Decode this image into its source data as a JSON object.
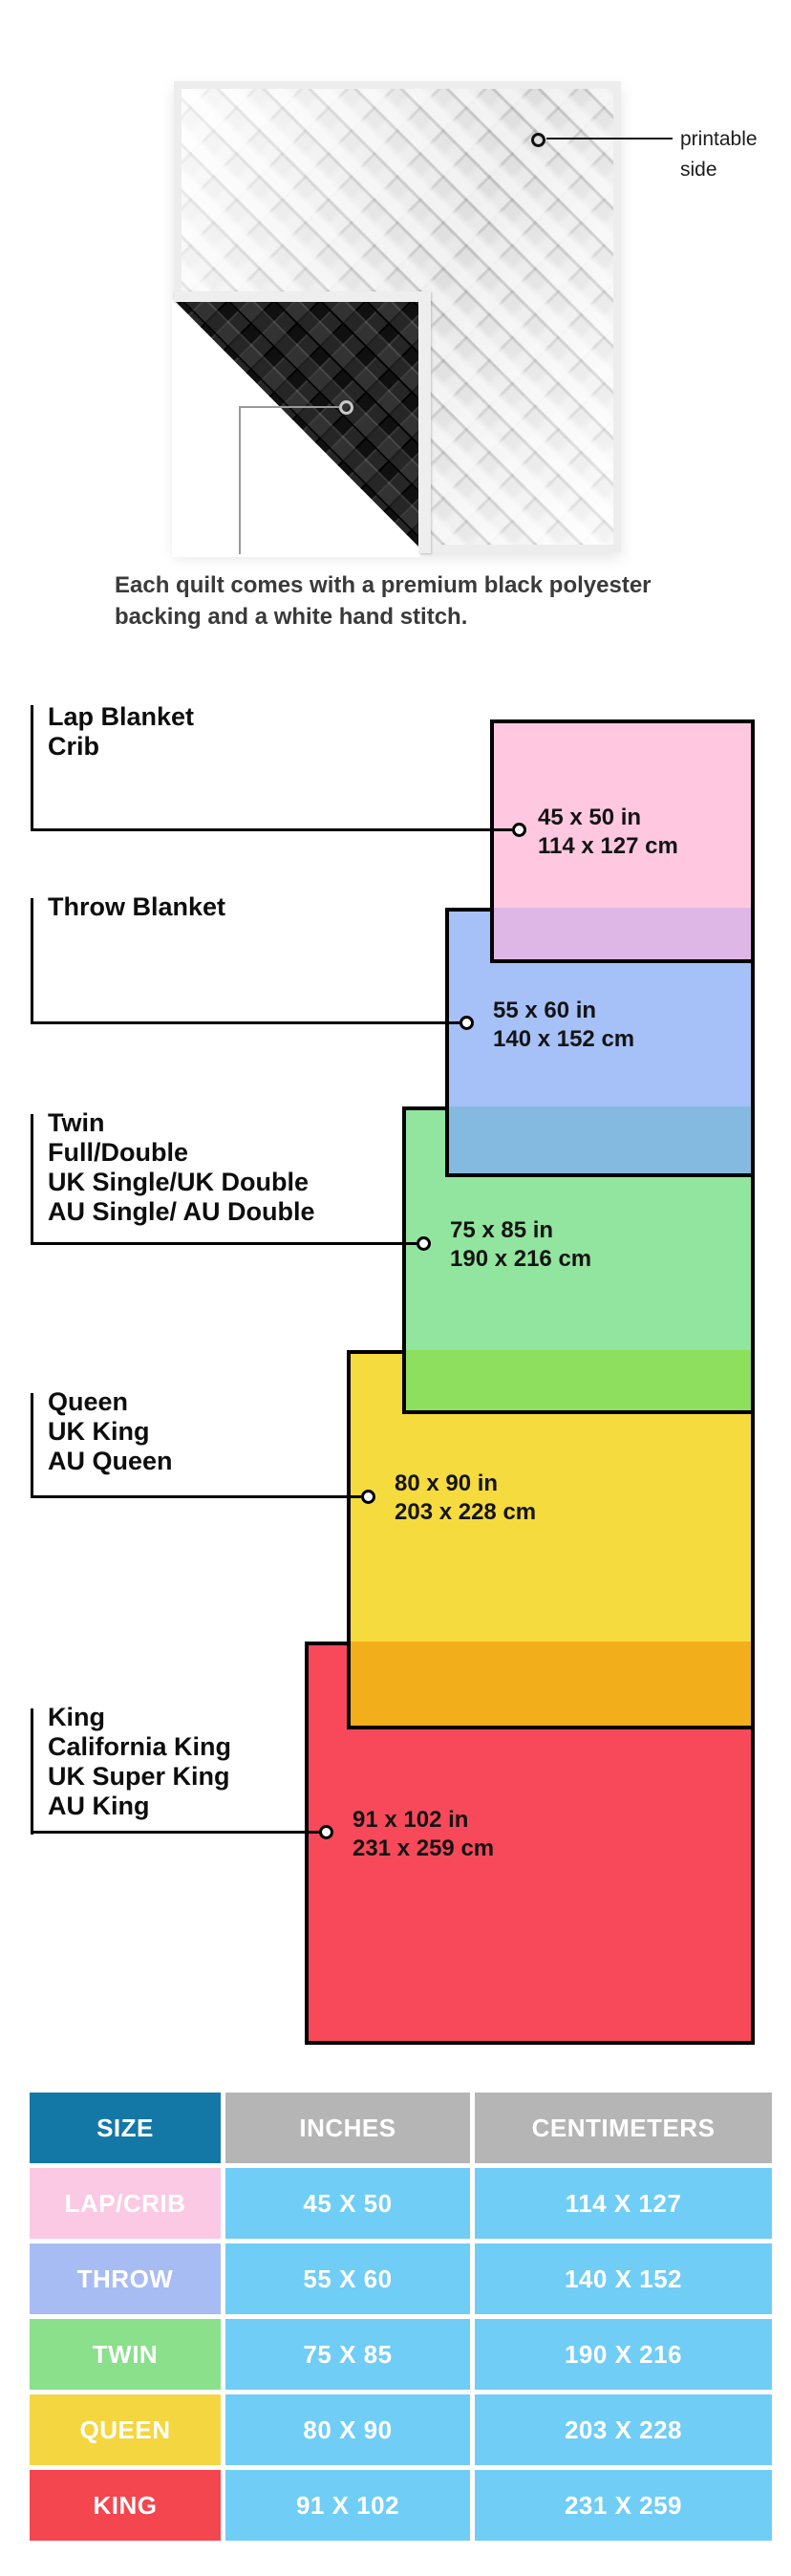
{
  "quilt_section": {
    "printable_lines": [
      "printable",
      "side"
    ],
    "caption_lines": [
      "Each quilt comes with a premium black polyester",
      "backing and a white hand stitch."
    ],
    "front_color": "#f3f3f3",
    "backing_color": "#101010"
  },
  "diagram": {
    "blankets": [
      {
        "id": "lap",
        "label_lines": [
          "Lap Blanket",
          "Crib"
        ],
        "size_in": "45 x 50 in",
        "size_cm": "114 x 127 cm",
        "fill": "#FFC8E0",
        "overlap_band": "#DEB7E6"
      },
      {
        "id": "throw",
        "label_lines": [
          "Throw Blanket"
        ],
        "size_in": "55 x 60 in",
        "size_cm": "140 x 152 cm",
        "fill": "#A6C0F8",
        "overlap_band": "#85BAE0"
      },
      {
        "id": "twin",
        "label_lines": [
          "Twin",
          "Full/Double",
          "UK Single/UK Double",
          "AU Single/ AU Double"
        ],
        "size_in": "75 x 85 in",
        "size_cm": "190 x 216 cm",
        "fill": "#92E59E",
        "overlap_band": "#8EDF5D"
      },
      {
        "id": "queen",
        "label_lines": [
          "Queen",
          "UK King",
          "AU Queen"
        ],
        "size_in": "80 x 90 in",
        "size_cm": "203 x 228 cm",
        "fill": "#F5DB3E",
        "overlap_band": "#F3AE1B"
      },
      {
        "id": "king",
        "label_lines": [
          "King",
          "California King",
          "UK Super King",
          "AU King"
        ],
        "size_in": "91 x 102 in",
        "size_cm": "231 x 259 cm",
        "fill": "#F8495B",
        "overlap_band": null
      }
    ],
    "border_color": "#000000"
  },
  "table": {
    "headers": [
      "SIZE",
      "INCHES",
      "CENTIMETERS"
    ],
    "header_size_bg": "#1478A6",
    "header_other_bg": "#B5B5B5",
    "value_cell_bg": "#70CDF6",
    "rows": [
      {
        "size": "LAP/CRIB",
        "inches": "45 X 50",
        "centimeters": "114 X 127",
        "size_bg": "#FBC9E3"
      },
      {
        "size": "THROW",
        "inches": "55 X 60",
        "centimeters": "140 X 152",
        "size_bg": "#A8BCF4"
      },
      {
        "size": "TWIN",
        "inches": "75 X 85",
        "centimeters": "190 X 216",
        "size_bg": "#8BE08B"
      },
      {
        "size": "QUEEN",
        "inches": "80 X 90",
        "centimeters": "203 X 228",
        "size_bg": "#F4D640"
      },
      {
        "size": "KING",
        "inches": "91 X 102",
        "centimeters": "231 X 259",
        "size_bg": "#F3464F"
      }
    ]
  }
}
